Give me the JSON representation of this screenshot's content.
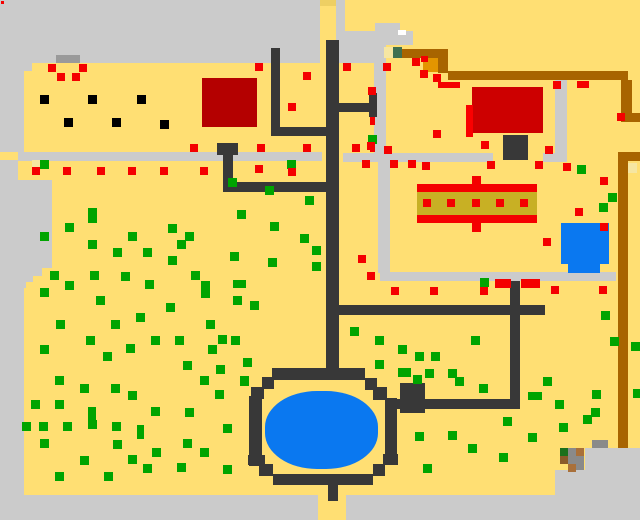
{
  "map": {
    "width": 640,
    "height": 520,
    "field_color": "#ffdf73"
  },
  "palette": {
    "field": "#ffdf73",
    "gray": "#cbcbcb",
    "darkgray": "#9a9a9a",
    "midgray": "#8a8a8a",
    "path": "#383838",
    "black": "#000000",
    "brown": "#a86400",
    "orange": "#e39500",
    "red": "#f40000",
    "bldgl": "#b40000",
    "bldgr": "#cd0000",
    "sliver": "#fa0000",
    "olive": "#c8b024",
    "blue": "#0a78f0",
    "pale": "#f6e6a2",
    "dgreen": "#3f7050",
    "white": "#ffffff",
    "green": "#00a400",
    "tipyellow": "#eecf63",
    "hbrown1": "#a9703a",
    "hbrown2": "#8a5a2a",
    "hgreen": "#1c701c"
  },
  "regions": [
    {
      "n": "top-gray-band",
      "x": 0,
      "y": 0,
      "w": 320,
      "h": 63,
      "c": "gray"
    },
    {
      "n": "gray-col-sliver",
      "x": 336,
      "y": 0,
      "w": 9,
      "h": 63,
      "c": "gray"
    },
    {
      "n": "gray-pocket-a",
      "x": 375,
      "y": 23,
      "w": 25,
      "h": 8,
      "c": "gray"
    },
    {
      "n": "gray-pocket-b",
      "x": 370,
      "y": 31,
      "w": 43,
      "h": 14,
      "c": "gray"
    },
    {
      "n": "gray-pocket-c",
      "x": 345,
      "y": 31,
      "w": 30,
      "h": 32,
      "c": "gray"
    },
    {
      "n": "left-border-1",
      "x": 0,
      "y": 63,
      "w": 32,
      "h": 8,
      "c": "gray"
    },
    {
      "n": "left-border-2",
      "x": 0,
      "y": 71,
      "w": 24,
      "h": 81,
      "c": "gray"
    },
    {
      "n": "left-border-3",
      "x": 0,
      "y": 160,
      "w": 18,
      "h": 20,
      "c": "gray"
    },
    {
      "n": "left-border-4",
      "x": 0,
      "y": 180,
      "w": 52,
      "h": 88,
      "c": "gray"
    },
    {
      "n": "left-border-5",
      "x": 0,
      "y": 268,
      "w": 42,
      "h": 8,
      "c": "gray"
    },
    {
      "n": "left-border-6",
      "x": 0,
      "y": 276,
      "w": 33,
      "h": 6,
      "c": "gray"
    },
    {
      "n": "left-border-7",
      "x": 0,
      "y": 282,
      "w": 26,
      "h": 6,
      "c": "gray"
    },
    {
      "n": "left-border-8",
      "x": 0,
      "y": 288,
      "w": 24,
      "h": 207,
      "c": "gray"
    },
    {
      "n": "bottom-strip-left",
      "x": 0,
      "y": 495,
      "w": 318,
      "h": 25,
      "c": "gray"
    },
    {
      "n": "bottom-strip-right",
      "x": 346,
      "y": 495,
      "w": 294,
      "h": 25,
      "c": "gray"
    },
    {
      "n": "bottom-right-gray-upper",
      "x": 585,
      "y": 448,
      "w": 55,
      "h": 47,
      "c": "gray"
    },
    {
      "n": "bottom-right-gray-lower",
      "x": 555,
      "y": 470,
      "w": 85,
      "h": 25,
      "c": "gray"
    },
    {
      "n": "sidewalk-h-left",
      "x": 18,
      "y": 152,
      "w": 304,
      "h": 9,
      "c": "gray"
    },
    {
      "n": "sidewalk-h-mid",
      "x": 343,
      "y": 153,
      "w": 150,
      "h": 9,
      "c": "gray"
    },
    {
      "n": "sidewalk-h-right",
      "x": 543,
      "y": 153,
      "w": 24,
      "h": 9,
      "c": "gray"
    },
    {
      "n": "sidewalk-v-east",
      "x": 555,
      "y": 80,
      "w": 12,
      "h": 73,
      "c": "gray"
    },
    {
      "n": "sidewalk-v-north",
      "x": 374,
      "y": 42,
      "w": 12,
      "h": 120,
      "c": "gray"
    },
    {
      "n": "sidewalk-v-south",
      "x": 378,
      "y": 162,
      "w": 12,
      "h": 111,
      "c": "gray"
    },
    {
      "n": "sidewalk-h-lower",
      "x": 380,
      "y": 272,
      "w": 236,
      "h": 9,
      "c": "gray"
    },
    {
      "n": "dark-bar-top",
      "x": 56,
      "y": 55,
      "w": 24,
      "h": 8,
      "c": "darkgray"
    },
    {
      "n": "yellow-col-tip",
      "x": 320,
      "y": 0,
      "w": 16,
      "h": 6,
      "c": "tipyellow"
    },
    {
      "n": "brown-path-h1",
      "x": 400,
      "y": 49,
      "w": 48,
      "h": 9,
      "c": "brown"
    },
    {
      "n": "brown-path-v1",
      "x": 438,
      "y": 56,
      "w": 10,
      "h": 17,
      "c": "brown"
    },
    {
      "n": "brown-path-h2",
      "x": 448,
      "y": 71,
      "w": 180,
      "h": 9,
      "c": "brown"
    },
    {
      "n": "brown-path-v2",
      "x": 621,
      "y": 80,
      "w": 11,
      "h": 33,
      "c": "brown"
    },
    {
      "n": "brown-stub-upper",
      "x": 621,
      "y": 113,
      "w": 19,
      "h": 9,
      "c": "brown"
    },
    {
      "n": "brown-stub-lower",
      "x": 618,
      "y": 152,
      "w": 22,
      "h": 9,
      "c": "brown"
    },
    {
      "n": "brown-path-v3",
      "x": 618,
      "y": 161,
      "w": 10,
      "h": 287,
      "c": "brown"
    },
    {
      "n": "orange-block",
      "x": 423,
      "y": 58,
      "w": 15,
      "h": 14,
      "c": "orange"
    },
    {
      "n": "pale-patch-1",
      "x": 384,
      "y": 47,
      "w": 9,
      "h": 11,
      "c": "pale"
    },
    {
      "n": "dark-green-square",
      "x": 393,
      "y": 47,
      "w": 9,
      "h": 11,
      "c": "dgreen"
    },
    {
      "n": "pale-patch-2",
      "x": 628,
      "y": 163,
      "w": 9,
      "h": 10,
      "c": "pale"
    },
    {
      "n": "pale-patch-3",
      "x": 32,
      "y": 160,
      "w": 8,
      "h": 7,
      "c": "pale"
    },
    {
      "n": "white-notch",
      "x": 398,
      "y": 30,
      "w": 8,
      "h": 5,
      "c": "white"
    },
    {
      "n": "road-main-vertical",
      "x": 326,
      "y": 40,
      "w": 13,
      "h": 328,
      "c": "path"
    },
    {
      "n": "road-left-vertical",
      "x": 271,
      "y": 48,
      "w": 9,
      "h": 87,
      "c": "path"
    },
    {
      "n": "road-left-horizontal",
      "x": 271,
      "y": 127,
      "w": 57,
      "h": 9,
      "c": "path"
    },
    {
      "n": "well-top",
      "x": 217,
      "y": 143,
      "w": 21,
      "h": 12,
      "c": "path"
    },
    {
      "n": "well-stem",
      "x": 223,
      "y": 155,
      "w": 10,
      "h": 37,
      "c": "path"
    },
    {
      "n": "road-h-185",
      "x": 223,
      "y": 182,
      "w": 105,
      "h": 10,
      "c": "path"
    },
    {
      "n": "road-building-h",
      "x": 335,
      "y": 103,
      "w": 40,
      "h": 9,
      "c": "path"
    },
    {
      "n": "road-building-v",
      "x": 369,
      "y": 93,
      "w": 8,
      "h": 24,
      "c": "path"
    },
    {
      "n": "road-h-310",
      "x": 326,
      "y": 305,
      "w": 219,
      "h": 10,
      "c": "path"
    },
    {
      "n": "road-right-vertical",
      "x": 510,
      "y": 281,
      "w": 10,
      "h": 128,
      "c": "path"
    },
    {
      "n": "road-pond-h",
      "x": 390,
      "y": 399,
      "w": 130,
      "h": 10,
      "c": "path"
    },
    {
      "n": "building-left",
      "x": 202,
      "y": 78,
      "w": 55,
      "h": 49,
      "c": "bldgl"
    },
    {
      "n": "building-right",
      "x": 472,
      "y": 87,
      "w": 71,
      "h": 46,
      "c": "bldgr"
    },
    {
      "n": "building-right-sliver",
      "x": 466,
      "y": 105,
      "w": 7,
      "h": 32,
      "c": "sliver"
    },
    {
      "n": "chimney",
      "x": 503,
      "y": 135,
      "w": 25,
      "h": 25,
      "c": "path"
    },
    {
      "n": "stall-top-bar",
      "x": 417,
      "y": 184,
      "w": 120,
      "h": 8,
      "c": "red"
    },
    {
      "n": "stall-olive-band",
      "x": 417,
      "y": 192,
      "w": 120,
      "h": 23,
      "c": "olive"
    },
    {
      "n": "stall-bottom-bar",
      "x": 417,
      "y": 215,
      "w": 120,
      "h": 8,
      "c": "red"
    },
    {
      "n": "stall-nub-top",
      "x": 472,
      "y": 176,
      "w": 9,
      "h": 8,
      "c": "red"
    },
    {
      "n": "stall-nub-bottom",
      "x": 472,
      "y": 223,
      "w": 9,
      "h": 9,
      "c": "red"
    },
    {
      "n": "pond-ring-top",
      "x": 272,
      "y": 368,
      "w": 93,
      "h": 12,
      "c": "path"
    },
    {
      "n": "pond-ring-tl1",
      "x": 262,
      "y": 377,
      "w": 12,
      "h": 12,
      "c": "path"
    },
    {
      "n": "pond-ring-tl2",
      "x": 251,
      "y": 387,
      "w": 13,
      "h": 12,
      "c": "path"
    },
    {
      "n": "pond-ring-left",
      "x": 249,
      "y": 396,
      "w": 13,
      "h": 70,
      "c": "path"
    },
    {
      "n": "pond-ring-bl1",
      "x": 248,
      "y": 455,
      "w": 17,
      "h": 10,
      "c": "path"
    },
    {
      "n": "pond-ring-bl2",
      "x": 259,
      "y": 464,
      "w": 14,
      "h": 12,
      "c": "path"
    },
    {
      "n": "pond-ring-bottom",
      "x": 273,
      "y": 474,
      "w": 100,
      "h": 11,
      "c": "path"
    },
    {
      "n": "pond-ring-br1",
      "x": 373,
      "y": 464,
      "w": 12,
      "h": 12,
      "c": "path"
    },
    {
      "n": "pond-ring-br2",
      "x": 383,
      "y": 454,
      "w": 15,
      "h": 11,
      "c": "path"
    },
    {
      "n": "pond-ring-right",
      "x": 385,
      "y": 398,
      "w": 12,
      "h": 58,
      "c": "path"
    },
    {
      "n": "pond-ring-tr1",
      "x": 365,
      "y": 378,
      "w": 12,
      "h": 12,
      "c": "path"
    },
    {
      "n": "pond-ring-tr2",
      "x": 373,
      "y": 387,
      "w": 14,
      "h": 13,
      "c": "path"
    },
    {
      "n": "pond-junction",
      "x": 400,
      "y": 383,
      "w": 25,
      "h": 30,
      "c": "path"
    },
    {
      "n": "pond-stem-bottom",
      "x": 328,
      "y": 485,
      "w": 10,
      "h": 16,
      "c": "path"
    },
    {
      "n": "pond-water",
      "x": 265,
      "y": 391,
      "w": 113,
      "h": 78,
      "c": "blue",
      "r": "46%"
    },
    {
      "n": "small-pond-water",
      "x": 561,
      "y": 223,
      "w": 48,
      "h": 41,
      "c": "blue"
    },
    {
      "n": "small-pond-notch",
      "x": 568,
      "y": 264,
      "w": 32,
      "h": 9,
      "c": "blue"
    },
    {
      "n": "hut-gray-bar",
      "x": 592,
      "y": 440,
      "w": 16,
      "h": 8,
      "c": "midgray"
    },
    {
      "n": "hut-gray-block",
      "x": 568,
      "y": 448,
      "w": 16,
      "h": 22,
      "c": "midgray"
    },
    {
      "n": "hut-green",
      "x": 560,
      "y": 448,
      "w": 8,
      "h": 8,
      "c": "hgreen"
    },
    {
      "n": "hut-brown-1",
      "x": 576,
      "y": 448,
      "w": 8,
      "h": 8,
      "c": "hbrown1"
    },
    {
      "n": "hut-brown-2",
      "x": 560,
      "y": 456,
      "w": 8,
      "h": 8,
      "c": "hbrown2"
    },
    {
      "n": "hut-brown-3",
      "x": 568,
      "y": 464,
      "w": 8,
      "h": 8,
      "c": "hbrown1"
    },
    {
      "n": "corner-red-dot",
      "x": 1,
      "y": 1,
      "w": 3,
      "h": 3,
      "c": "red"
    }
  ],
  "dots": {
    "green_size": [
      9,
      9
    ],
    "red_size": [
      8,
      8
    ],
    "black_size": [
      9,
      9
    ],
    "green": [
      [
        368,
        135
      ],
      [
        480,
        278
      ],
      [
        577,
        165
      ],
      [
        608,
        193
      ],
      [
        599,
        203
      ],
      [
        287,
        160
      ],
      [
        40,
        160
      ],
      [
        88,
        208,
        9,
        15
      ],
      [
        65,
        223
      ],
      [
        40,
        232
      ],
      [
        128,
        232
      ],
      [
        168,
        224
      ],
      [
        185,
        232
      ],
      [
        88,
        240
      ],
      [
        177,
        240
      ],
      [
        113,
        248
      ],
      [
        143,
        248
      ],
      [
        168,
        256
      ],
      [
        228,
        178
      ],
      [
        265,
        186
      ],
      [
        305,
        196
      ],
      [
        237,
        210
      ],
      [
        270,
        222
      ],
      [
        300,
        234
      ],
      [
        230,
        252
      ],
      [
        268,
        258
      ],
      [
        312,
        262
      ],
      [
        312,
        246
      ],
      [
        50,
        271
      ],
      [
        90,
        271
      ],
      [
        121,
        272
      ],
      [
        191,
        271
      ],
      [
        65,
        281
      ],
      [
        145,
        280
      ],
      [
        201,
        281,
        9,
        17
      ],
      [
        233,
        280,
        13,
        8
      ],
      [
        40,
        288
      ],
      [
        96,
        296
      ],
      [
        233,
        296
      ],
      [
        250,
        301
      ],
      [
        166,
        303
      ],
      [
        136,
        313
      ],
      [
        56,
        320
      ],
      [
        111,
        320
      ],
      [
        206,
        320
      ],
      [
        86,
        336
      ],
      [
        151,
        336
      ],
      [
        175,
        336
      ],
      [
        218,
        335
      ],
      [
        231,
        336
      ],
      [
        40,
        345
      ],
      [
        126,
        344
      ],
      [
        208,
        345
      ],
      [
        103,
        352
      ],
      [
        183,
        361
      ],
      [
        216,
        365
      ],
      [
        55,
        376
      ],
      [
        80,
        384
      ],
      [
        111,
        384
      ],
      [
        200,
        376
      ],
      [
        240,
        376
      ],
      [
        128,
        391
      ],
      [
        215,
        390
      ],
      [
        31,
        400
      ],
      [
        55,
        400
      ],
      [
        88,
        407,
        8,
        13
      ],
      [
        151,
        407
      ],
      [
        185,
        408
      ],
      [
        22,
        422
      ],
      [
        39,
        422
      ],
      [
        63,
        422
      ],
      [
        88,
        420
      ],
      [
        112,
        422
      ],
      [
        137,
        425,
        7,
        14
      ],
      [
        223,
        424
      ],
      [
        40,
        439
      ],
      [
        113,
        440
      ],
      [
        183,
        439
      ],
      [
        200,
        448
      ],
      [
        152,
        448
      ],
      [
        128,
        455
      ],
      [
        143,
        464
      ],
      [
        80,
        456
      ],
      [
        55,
        472
      ],
      [
        104,
        472
      ],
      [
        177,
        463
      ],
      [
        243,
        358
      ],
      [
        375,
        360
      ],
      [
        402,
        368
      ],
      [
        240,
        377
      ],
      [
        223,
        465
      ],
      [
        423,
        464
      ],
      [
        350,
        327
      ],
      [
        375,
        336
      ],
      [
        471,
        336
      ],
      [
        398,
        345
      ],
      [
        415,
        352
      ],
      [
        431,
        352
      ],
      [
        398,
        368
      ],
      [
        425,
        369
      ],
      [
        448,
        369
      ],
      [
        455,
        377
      ],
      [
        479,
        384
      ],
      [
        413,
        375
      ],
      [
        543,
        377
      ],
      [
        528,
        392,
        14,
        8
      ],
      [
        592,
        390
      ],
      [
        555,
        400
      ],
      [
        591,
        408
      ],
      [
        583,
        415
      ],
      [
        559,
        423
      ],
      [
        503,
        417
      ],
      [
        415,
        432
      ],
      [
        448,
        431
      ],
      [
        528,
        433
      ],
      [
        601,
        311
      ],
      [
        610,
        337
      ],
      [
        631,
        342
      ],
      [
        633,
        389
      ],
      [
        468,
        444
      ],
      [
        499,
        453
      ]
    ],
    "red": [
      [
        48,
        64
      ],
      [
        79,
        64
      ],
      [
        57,
        73
      ],
      [
        72,
        73
      ],
      [
        255,
        63
      ],
      [
        343,
        63
      ],
      [
        383,
        63
      ],
      [
        412,
        58
      ],
      [
        421,
        56,
        7,
        6
      ],
      [
        420,
        70
      ],
      [
        433,
        74
      ],
      [
        438,
        82,
        22,
        6
      ],
      [
        553,
        81
      ],
      [
        577,
        81,
        12,
        7
      ],
      [
        617,
        113
      ],
      [
        303,
        72
      ],
      [
        368,
        87
      ],
      [
        288,
        103
      ],
      [
        433,
        130
      ],
      [
        370,
        117,
        5,
        8
      ],
      [
        384,
        146
      ],
      [
        367,
        142
      ],
      [
        481,
        141
      ],
      [
        545,
        146
      ],
      [
        190,
        144
      ],
      [
        257,
        144
      ],
      [
        303,
        144
      ],
      [
        352,
        144
      ],
      [
        370,
        143,
        5,
        9
      ],
      [
        32,
        167
      ],
      [
        63,
        167
      ],
      [
        97,
        167
      ],
      [
        128,
        167
      ],
      [
        160,
        167
      ],
      [
        200,
        167
      ],
      [
        255,
        165
      ],
      [
        288,
        168
      ],
      [
        362,
        160
      ],
      [
        390,
        160
      ],
      [
        408,
        160
      ],
      [
        422,
        162
      ],
      [
        487,
        161
      ],
      [
        535,
        161
      ],
      [
        563,
        163
      ],
      [
        423,
        199
      ],
      [
        447,
        199
      ],
      [
        472,
        199
      ],
      [
        496,
        199
      ],
      [
        520,
        199
      ],
      [
        575,
        208
      ],
      [
        600,
        223
      ],
      [
        543,
        238
      ],
      [
        600,
        177
      ],
      [
        358,
        255
      ],
      [
        367,
        272
      ],
      [
        391,
        287
      ],
      [
        430,
        287
      ],
      [
        480,
        287
      ],
      [
        495,
        279,
        16,
        9
      ],
      [
        521,
        279,
        19,
        9
      ],
      [
        551,
        286
      ],
      [
        599,
        286
      ]
    ],
    "black": [
      [
        40,
        95
      ],
      [
        88,
        95
      ],
      [
        137,
        95
      ],
      [
        64,
        118
      ],
      [
        112,
        118
      ],
      [
        160,
        120
      ]
    ]
  }
}
